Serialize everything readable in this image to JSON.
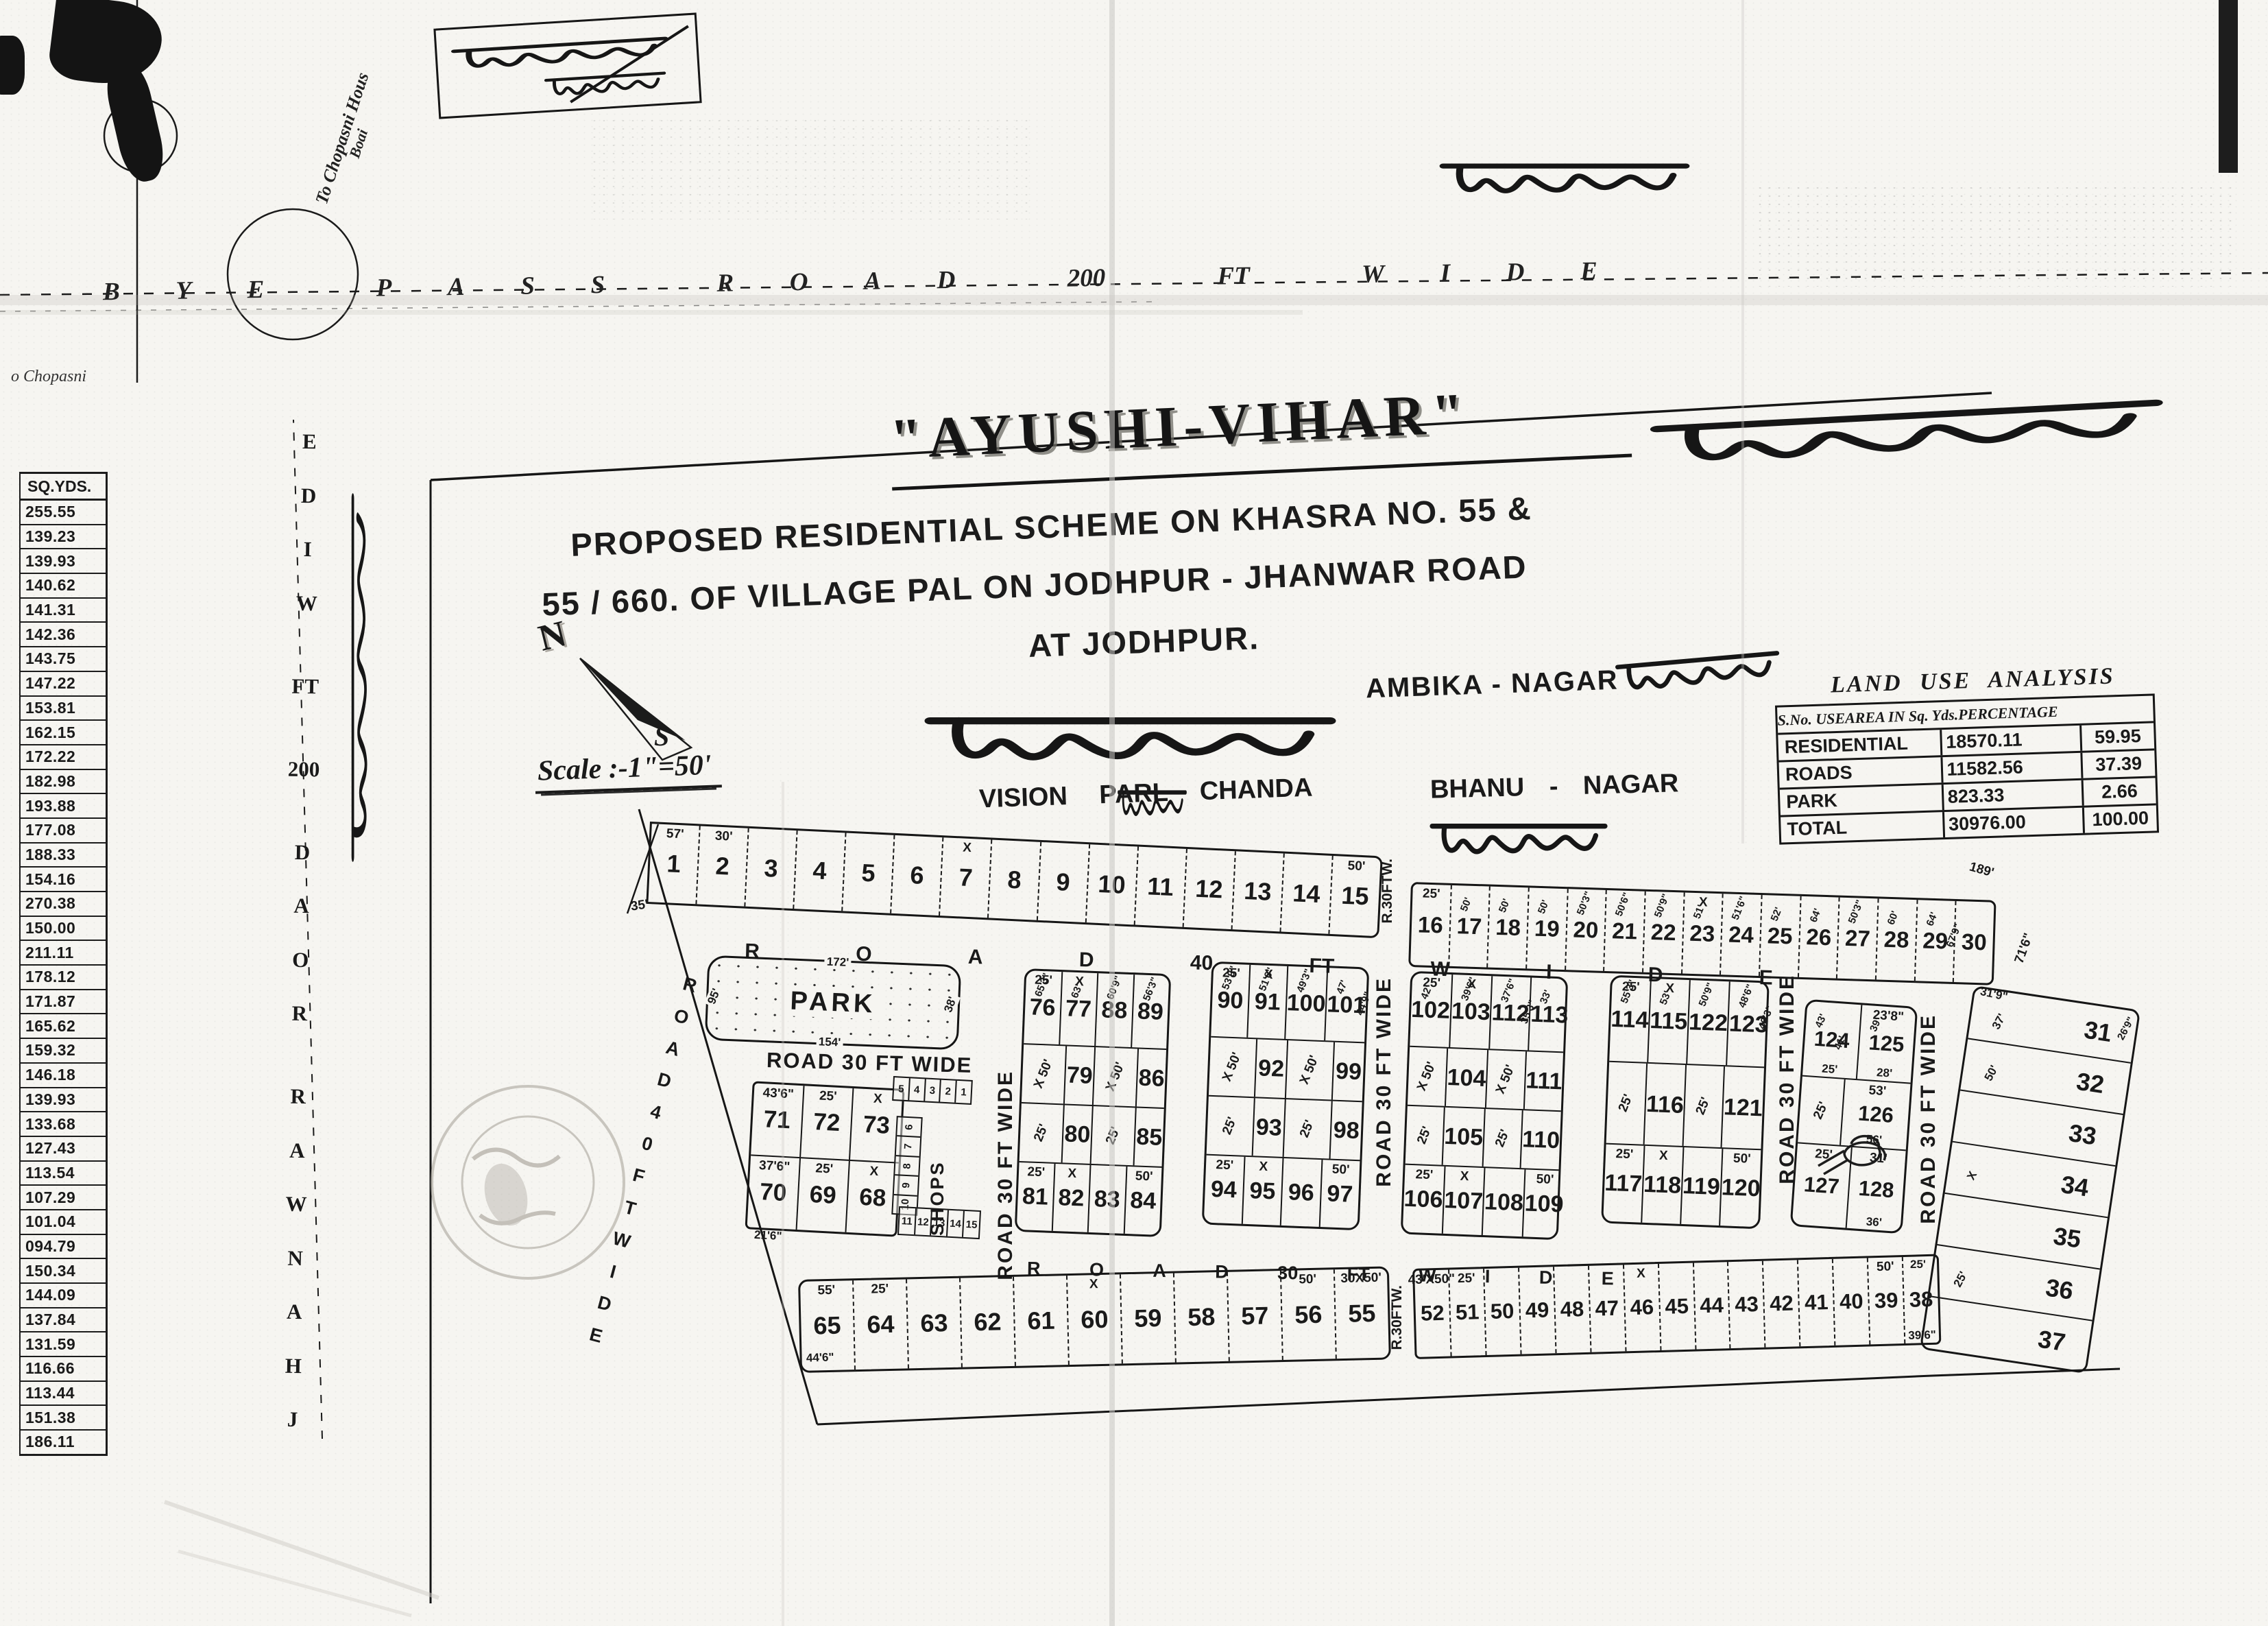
{
  "top": {
    "bypass_letters": [
      "B",
      "Y",
      "E",
      "",
      "P",
      "A",
      "S",
      "S",
      "",
      "R",
      "O",
      "A",
      "D",
      "",
      "200",
      "",
      "FT",
      "",
      "W",
      "I",
      "D",
      "E"
    ],
    "to_chopasni_line1": "To Chopasni Hous",
    "to_chopasni_line2": "Boai",
    "chopasni": "o Chopasni",
    "hw_box": "डाली बाई मंदिर",
    "hw_bai_pass": "बाई पास"
  },
  "title_block": {
    "title": "\"AYUSHI-VIHAR\"",
    "line1": "PROPOSED  RESIDENTIAL  SCHEME  ON  KHASRA  NO. 55 &",
    "line2": "55 / 660.  OF  VILLAGE  PAL  ON  JODHPUR - JHANWAR  ROAD",
    "line3": "AT  JODHPUR.",
    "hw_right": "डाली बाई मंदिर के सामने"
  },
  "compass": {
    "north": "N",
    "south": "S"
  },
  "scale_label": "Scale :-1\"=50'",
  "labels": {
    "ambika": "AMBIKA - NAGAR",
    "ambika_hw": "अम्बिका नगर",
    "vision": "VISION PARL CHANDA",
    "vision_hw": "विजोला पार्ल चंडा",
    "vision_hw_small": "पर्ल",
    "bhanu": "BHANU - NAGAR",
    "bhanu_hw": "के भाणू नगट",
    "jhanwar_hw": "झुराणी झांवर रोड"
  },
  "land_use": {
    "title": "LAND USE ANALYSIS",
    "headers": [
      "S.No.  USE",
      "AREA IN  Sq. Yds.",
      "PERCENTAGE"
    ],
    "rows": [
      [
        "RESIDENTIAL",
        "18570.11",
        "59.95"
      ],
      [
        "ROADS",
        "11582.56",
        "37.39"
      ],
      [
        "PARK",
        "823.33",
        "2.66"
      ],
      [
        "TOTAL",
        "30976.00",
        "100.00"
      ]
    ]
  },
  "sqyds": {
    "header": "SQ.YDS.",
    "values": [
      "255.55",
      "139.23",
      "139.93",
      "140.62",
      "141.31",
      "142.36",
      "143.75",
      "147.22",
      "153.81",
      "162.15",
      "172.22",
      "182.98",
      "193.88",
      "177.08",
      "188.33",
      "154.16",
      "270.38",
      "150.00",
      "211.11",
      "178.12",
      "171.87",
      "165.62",
      "159.32",
      "146.18",
      "139.93",
      "133.68",
      "127.43",
      "113.54",
      "107.29",
      "101.04",
      "094.79",
      "150.34",
      "144.09",
      "137.84",
      "131.59",
      "116.66",
      "113.44",
      "151.38",
      "186.11"
    ]
  },
  "roads": {
    "jhanwar_letters": [
      "J",
      "H",
      "A",
      "N",
      "W",
      "A",
      "R",
      "",
      "R",
      "O",
      "A",
      "D",
      "",
      "200",
      "",
      "FT",
      "",
      "W",
      "I",
      "D",
      "E"
    ],
    "diag_letters": [
      "R",
      "O",
      "A",
      "D",
      "4",
      "0",
      "F",
      "T",
      "W",
      "I",
      "D",
      "E"
    ],
    "road40_letters": [
      "R",
      "O",
      "A",
      "D",
      "40",
      "FT",
      "W",
      "I",
      "D",
      "E"
    ],
    "road30_letters": [
      "R",
      "O",
      "A",
      "D",
      "30",
      "FT",
      "W",
      "I",
      "D",
      "E"
    ],
    "road30_h": "ROAD 30 FT WIDE",
    "road30_v": "ROAD 30 FT WIDE",
    "r30ftw": "R.30FTW."
  },
  "park": {
    "label": "PARK",
    "top": "172'",
    "bottom": "154'",
    "left": "95'",
    "right": "38'"
  },
  "shops": {
    "label": "SHOPS",
    "top": [
      "5",
      "4",
      "3",
      "2",
      "1"
    ],
    "side": [
      "6",
      "7",
      "8",
      "9",
      "10"
    ],
    "bottom": [
      "11",
      "12",
      "13",
      "14",
      "15"
    ]
  },
  "row1": {
    "out": "35'",
    "plots": [
      {
        "no": "1",
        "top": "57'"
      },
      {
        "no": "2",
        "top": "30'"
      },
      {
        "no": "3"
      },
      {
        "no": "4"
      },
      {
        "no": "5"
      },
      {
        "no": "6"
      },
      {
        "no": "7",
        "top": "X"
      },
      {
        "no": "8"
      },
      {
        "no": "9"
      },
      {
        "no": "10"
      },
      {
        "no": "11"
      },
      {
        "no": "12"
      },
      {
        "no": "13"
      },
      {
        "no": "14"
      },
      {
        "no": "15",
        "top": "50'"
      }
    ]
  },
  "row2": {
    "out_tr": "189'",
    "out_r": "71'6\"",
    "out_br": "31'9\"",
    "plots": [
      {
        "no": "16",
        "top": "25'"
      },
      {
        "no": "17",
        "rot": "50'"
      },
      {
        "no": "18",
        "rot": "50'"
      },
      {
        "no": "19",
        "rot": "50'"
      },
      {
        "no": "20",
        "rot": "50'3\""
      },
      {
        "no": "21",
        "rot": "50'6\""
      },
      {
        "no": "22",
        "rot": "50'9\""
      },
      {
        "no": "23",
        "top": "X",
        "rot": "51'"
      },
      {
        "no": "24",
        "rot": "51'6\""
      },
      {
        "no": "25",
        "rot": "52'"
      },
      {
        "no": "26",
        "rot": "64'"
      },
      {
        "no": "27",
        "rot": "50'3\""
      },
      {
        "no": "28",
        "rot": "60'"
      },
      {
        "no": "29",
        "rot": "64'",
        "rot2": "67'9\""
      },
      {
        "no": "30"
      }
    ]
  },
  "block71": {
    "out": "21'6\"",
    "r1": [
      {
        "no": "71",
        "top": "43'6\""
      },
      {
        "no": "72",
        "top": "25'"
      },
      {
        "no": "73",
        "top": "X"
      }
    ],
    "r2": [
      {
        "no": "70",
        "top": "37'6\""
      },
      {
        "no": "69",
        "top": "25'"
      },
      {
        "no": "68",
        "top": "X"
      }
    ]
  },
  "blocks": {
    "a": {
      "r1": [
        {
          "no": "76",
          "top": "25'",
          "rot": "65'3\""
        },
        {
          "no": "77",
          "top": "X",
          "rot": "63'"
        },
        {
          "no": "88",
          "rot": "60'9\""
        },
        {
          "no": "89",
          "rot": "56'3\""
        }
      ],
      "r2": [
        {
          "dim": "X 50'",
          "no": "79"
        },
        {
          "dim": "X 50'",
          "no": "86"
        }
      ],
      "r3": [
        {
          "dim": "25'",
          "no": "80"
        },
        {
          "dim": "25'",
          "no": "85"
        }
      ],
      "r4": [
        {
          "no": "81",
          "top": "25'"
        },
        {
          "no": "82",
          "top": "X"
        },
        {
          "no": "83"
        },
        {
          "no": "84",
          "top": "50'"
        }
      ]
    },
    "b": {
      "r1": [
        {
          "no": "90",
          "top": "25'",
          "rot": "53'9\""
        },
        {
          "no": "91",
          "top": "X",
          "rot": "51'6\""
        },
        {
          "no": "100",
          "rot": "49'3\""
        },
        {
          "no": "101",
          "rot": "47'",
          "rot2": "44'9\""
        }
      ],
      "r2": [
        {
          "dim": "X 50'",
          "no": "92"
        },
        {
          "dim": "X 50'",
          "no": "99"
        }
      ],
      "r3": [
        {
          "dim": "25'",
          "no": "93"
        },
        {
          "dim": "25'",
          "no": "98"
        }
      ],
      "r4": [
        {
          "no": "94",
          "top": "25'"
        },
        {
          "no": "95",
          "top": "X"
        },
        {
          "no": "96"
        },
        {
          "no": "97",
          "top": "50'"
        }
      ]
    },
    "c": {
      "r1": [
        {
          "no": "102",
          "top": "25'",
          "rot": "42'"
        },
        {
          "no": "103",
          "top": "X",
          "rot": "39'6\""
        },
        {
          "no": "112",
          "rot": "37'6\"",
          "rot2": "35'3\""
        },
        {
          "no": "113",
          "rot": "33'"
        }
      ],
      "r2": [
        {
          "dim": "X 50'",
          "no": "104"
        },
        {
          "dim": "X 50'",
          "no": "111"
        }
      ],
      "r3": [
        {
          "dim": "25'",
          "no": "105"
        },
        {
          "dim": "25'",
          "no": "110"
        }
      ],
      "r4": [
        {
          "no": "106",
          "top": "25'"
        },
        {
          "no": "107",
          "top": "X"
        },
        {
          "no": "108"
        },
        {
          "no": "109",
          "top": "50'"
        }
      ]
    },
    "d": {
      "r1": [
        {
          "no": "114",
          "top": "25'",
          "rot": "55'3\""
        },
        {
          "no": "115",
          "top": "X",
          "rot": "53'"
        },
        {
          "no": "122",
          "rot": "50'9\""
        },
        {
          "no": "123",
          "rot": "48'6\"",
          "rot2": "46'3\""
        }
      ],
      "r2": [
        {
          "dim": "25'",
          "no": "116"
        },
        {
          "dim": "25'",
          "no": "121"
        }
      ],
      "r3": [
        {
          "no": "117",
          "top": "25'"
        },
        {
          "no": "118",
          "top": "X"
        },
        {
          "no": "119"
        },
        {
          "no": "120",
          "top": "50'"
        }
      ]
    },
    "e": {
      "r1": [
        {
          "no": "124",
          "rot": "43'",
          "rot2": "41'",
          "bottom": "25'"
        },
        {
          "no": "125",
          "top": "23'8\"",
          "rot": "39'",
          "bottom": "28'"
        }
      ],
      "r2": [
        {
          "dim": "25'",
          "no": "126",
          "top": "53'",
          "bottom": "56'"
        }
      ],
      "r3": [
        {
          "no": "127",
          "top": "25'"
        },
        {
          "no": "128",
          "top": "31'",
          "bottom": "36'"
        }
      ]
    }
  },
  "colF": {
    "plots": [
      {
        "no": "31",
        "left": "37'",
        "right": "26'9\""
      },
      {
        "no": "32",
        "left": "50'"
      },
      {
        "no": "33"
      },
      {
        "no": "34",
        "left": "X"
      },
      {
        "no": "35"
      },
      {
        "no": "36",
        "left": "25'"
      },
      {
        "no": "37"
      }
    ]
  },
  "rowG": {
    "out": "44'6\"",
    "plots": [
      {
        "no": "65",
        "top": "55'"
      },
      {
        "no": "64",
        "top": "25'"
      },
      {
        "no": "63"
      },
      {
        "no": "62"
      },
      {
        "no": "61"
      },
      {
        "no": "60",
        "top": "X"
      },
      {
        "no": "59"
      },
      {
        "no": "58"
      },
      {
        "no": "57"
      },
      {
        "no": "56",
        "top": "50'"
      },
      {
        "no": "55",
        "top": "30X50'"
      }
    ]
  },
  "rowH": {
    "out": "25'",
    "plots": [
      {
        "no": "52",
        "top": "43'X50\""
      },
      {
        "no": "51",
        "top": "25'"
      },
      {
        "no": "50"
      },
      {
        "no": "49"
      },
      {
        "no": "48"
      },
      {
        "no": "47"
      },
      {
        "no": "46",
        "top": "X"
      },
      {
        "no": "45"
      },
      {
        "no": "44"
      },
      {
        "no": "43"
      },
      {
        "no": "42"
      },
      {
        "no": "41"
      },
      {
        "no": "40"
      },
      {
        "no": "39",
        "top": "50'"
      },
      {
        "no": "38",
        "bottom": "39'6\""
      }
    ]
  }
}
